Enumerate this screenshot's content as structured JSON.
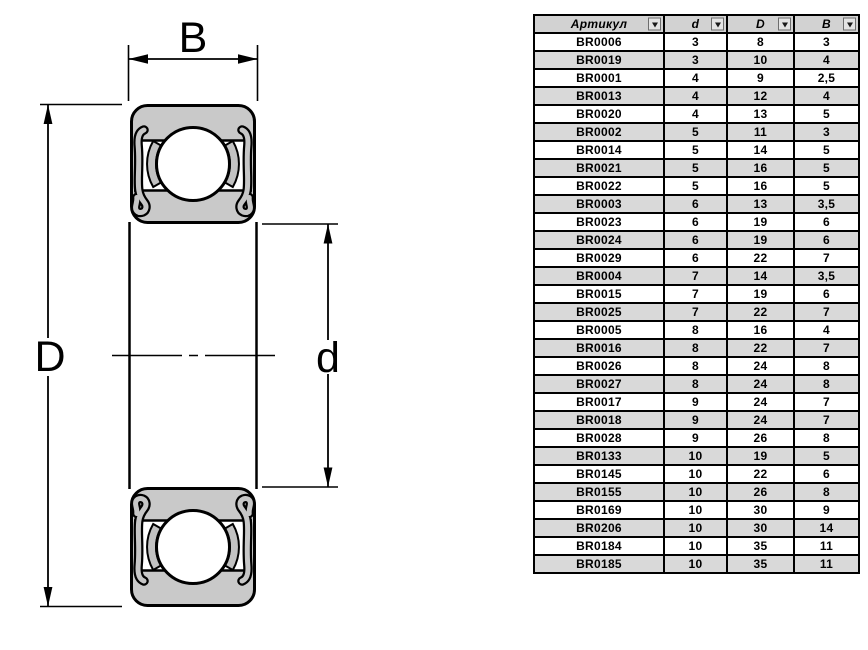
{
  "diagram": {
    "labels": {
      "width": "B",
      "outer_diameter": "D",
      "bore_diameter": "d"
    },
    "colors": {
      "ring_fill": "#c9c9c9",
      "seal_fill": "#c6c6c6",
      "cage_fill": "#c2c2c2",
      "line": "#000000"
    }
  },
  "table": {
    "columns": [
      {
        "label": "Артикул"
      },
      {
        "label": "d"
      },
      {
        "label": "D"
      },
      {
        "label": "B"
      }
    ],
    "rows": [
      [
        "BR0006",
        "3",
        "8",
        "3"
      ],
      [
        "BR0019",
        "3",
        "10",
        "4"
      ],
      [
        "BR0001",
        "4",
        "9",
        "2,5"
      ],
      [
        "BR0013",
        "4",
        "12",
        "4"
      ],
      [
        "BR0020",
        "4",
        "13",
        "5"
      ],
      [
        "BR0002",
        "5",
        "11",
        "3"
      ],
      [
        "BR0014",
        "5",
        "14",
        "5"
      ],
      [
        "BR0021",
        "5",
        "16",
        "5"
      ],
      [
        "BR0022",
        "5",
        "16",
        "5"
      ],
      [
        "BR0003",
        "6",
        "13",
        "3,5"
      ],
      [
        "BR0023",
        "6",
        "19",
        "6"
      ],
      [
        "BR0024",
        "6",
        "19",
        "6"
      ],
      [
        "BR0029",
        "6",
        "22",
        "7"
      ],
      [
        "BR0004",
        "7",
        "14",
        "3,5"
      ],
      [
        "BR0015",
        "7",
        "19",
        "6"
      ],
      [
        "BR0025",
        "7",
        "22",
        "7"
      ],
      [
        "BR0005",
        "8",
        "16",
        "4"
      ],
      [
        "BR0016",
        "8",
        "22",
        "7"
      ],
      [
        "BR0026",
        "8",
        "24",
        "8"
      ],
      [
        "BR0027",
        "8",
        "24",
        "8"
      ],
      [
        "BR0017",
        "9",
        "24",
        "7"
      ],
      [
        "BR0018",
        "9",
        "24",
        "7"
      ],
      [
        "BR0028",
        "9",
        "26",
        "8"
      ],
      [
        "BR0133",
        "10",
        "19",
        "5"
      ],
      [
        "BR0145",
        "10",
        "22",
        "6"
      ],
      [
        "BR0155",
        "10",
        "26",
        "8"
      ],
      [
        "BR0169",
        "10",
        "30",
        "9"
      ],
      [
        "BR0206",
        "10",
        "30",
        "14"
      ],
      [
        "BR0184",
        "10",
        "35",
        "11"
      ],
      [
        "BR0185",
        "10",
        "35",
        "11"
      ]
    ],
    "colors": {
      "header_bg": "#d2d2d2",
      "row_alt_bg": "#d9d9d9",
      "grid_line": "#000000"
    }
  }
}
